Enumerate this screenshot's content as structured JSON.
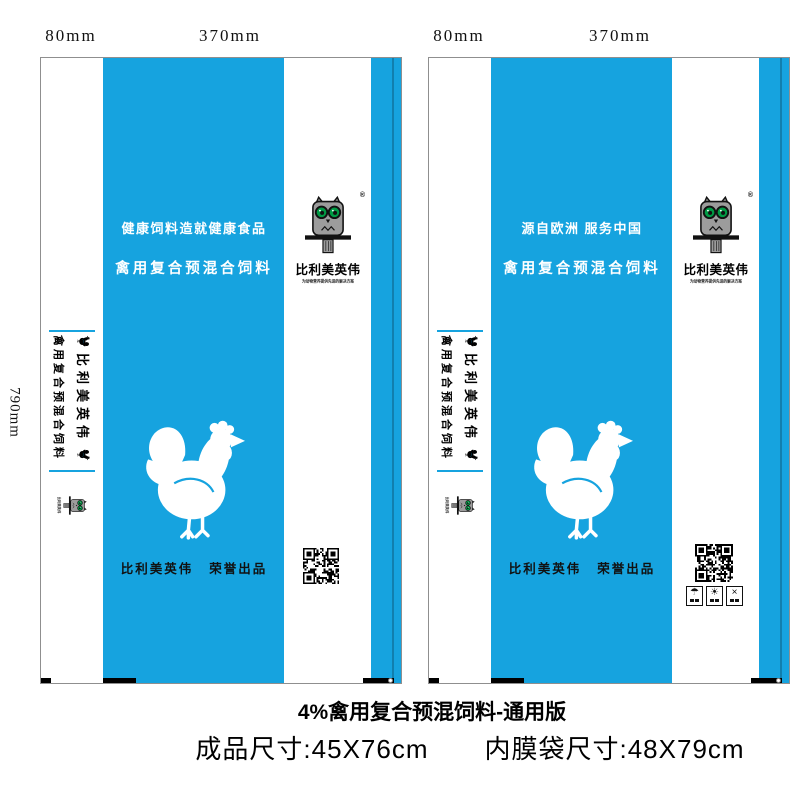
{
  "dimensions": {
    "gusset_width": "80mm",
    "face_width": "370mm",
    "bag_height": "790mm"
  },
  "brand": {
    "name": "比利美英伟",
    "registered": "®",
    "tagline": "为动物营养提供先进的解决方案"
  },
  "colors": {
    "blue": "#16A3DF",
    "blue-dark": "#0C82B6",
    "bracket": "#1E4278",
    "green": "#009A44",
    "owl-gray": "#9C9C9C",
    "ink": "#111111"
  },
  "bags": [
    {
      "name": "bag-front",
      "slogan": "健康饲料造就健康食品",
      "product_line": "禽用复合预混合饲料",
      "gusset_brand": "比利美英伟",
      "gusset_product": "禽用复合预混合饲料",
      "footer_brand": "比利美英伟",
      "footer_honor": "荣誉出品"
    },
    {
      "name": "bag-back",
      "slogan": "源自欧洲 服务中国",
      "product_line": "禽用复合预混合饲料",
      "gusset_brand": "比利美英伟",
      "gusset_product": "禽用复合预混合饲料",
      "footer_brand": "比利美英伟",
      "footer_honor": "荣誉出品"
    }
  ],
  "pack_icons": [
    {
      "name": "keep-dry",
      "glyph": "☂"
    },
    {
      "name": "keep-away-sun",
      "glyph": "☀"
    },
    {
      "name": "no-hooks",
      "glyph": "×"
    }
  ],
  "captions": {
    "title": "4%禽用复合预混饲料-通用版",
    "finished_size": "成品尺寸:45X76cm",
    "liner_size": "内膜袋尺寸:48X79cm"
  }
}
